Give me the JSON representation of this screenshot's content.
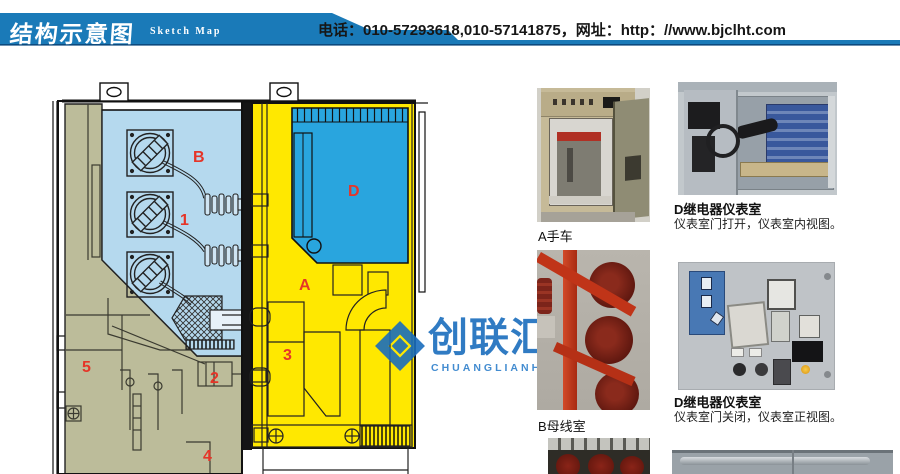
{
  "header": {
    "title": "结构示意图",
    "subtitle": "Sketch Map",
    "contact": "电话：010-57293618,010-57141875，网址：http：//www.bjclht.com",
    "bar_color": "#1a7ab8"
  },
  "watermark": {
    "name": "创联汇通",
    "romanized": "CHUANGLIANHUITONG",
    "color": "#1a6dbd"
  },
  "diagram": {
    "title": "结构示意图 (switchgear cross-section)",
    "labels": [
      {
        "text": "B"
      },
      {
        "text": "1"
      },
      {
        "text": "D"
      },
      {
        "text": "A"
      },
      {
        "text": "3"
      },
      {
        "text": "2"
      },
      {
        "text": "5"
      },
      {
        "text": "4"
      }
    ],
    "legend_colors": {
      "busbar_room": "#b5d9ee",
      "instrument_room": "#29a5de",
      "breaker_room": "#ffe800",
      "cable_room": "#bcbc9a",
      "label_red": "#e53528"
    }
  },
  "photos": [
    {
      "caption": "A手车"
    },
    {
      "caption": "D继电器仪表室",
      "description": "仪表室门打开，仪表室内视图。"
    },
    {
      "caption": "B母线室"
    },
    {
      "caption": "D继电器仪表室",
      "description": "仪表室门关闭，仪表室正视图。"
    }
  ]
}
